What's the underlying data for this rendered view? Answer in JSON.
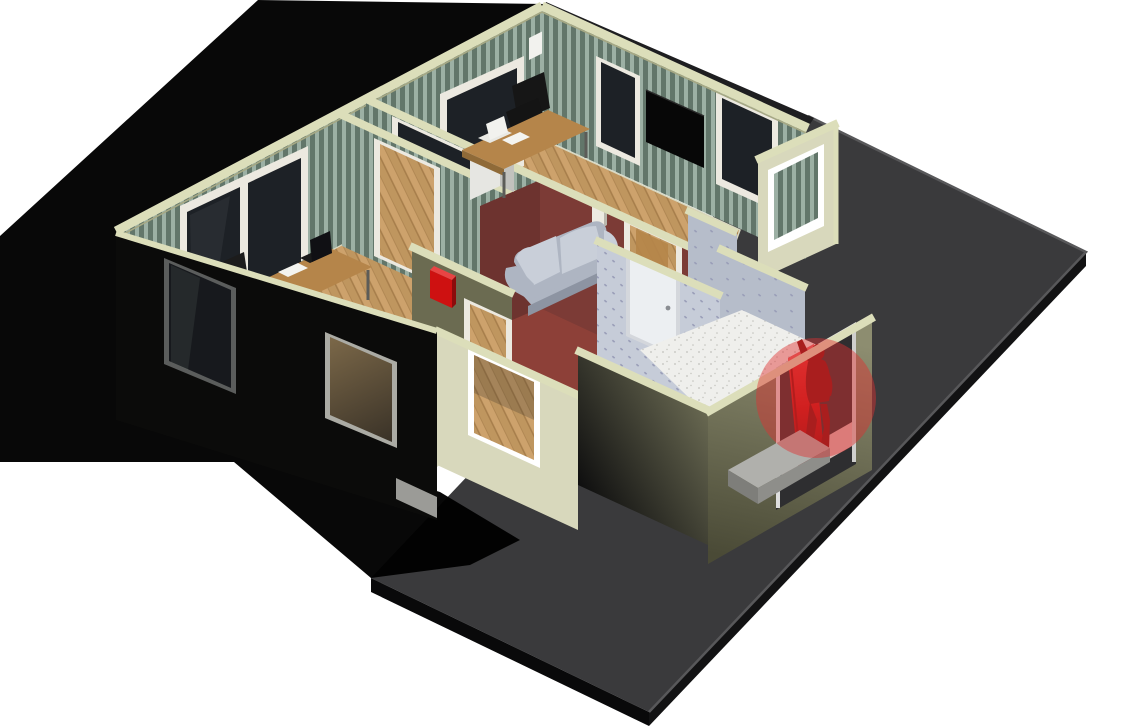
{
  "scene": {
    "title": "3D isometric cutaway floor-plan render",
    "view": "isometric",
    "alert": {
      "type": "person-detected-at-entrance",
      "marker": "translucent-red-circle",
      "marker_color": "#e03030",
      "marker_opacity": "0.45"
    }
  },
  "rooms": [
    {
      "id": "office-left",
      "floor": "wood-planks",
      "walls": "green-striped-wallpaper",
      "contents": [
        "l-desk",
        "laptop",
        "paper",
        "office-chair",
        "file-cabinet",
        "double-window"
      ]
    },
    {
      "id": "office-top",
      "floor": "wood-planks",
      "walls": "green-striped-wallpaper",
      "contents": [
        "l-desk",
        "laptop",
        "paper",
        "office-chair",
        "file-cabinet",
        "window",
        "wall-tv"
      ]
    },
    {
      "id": "living-room",
      "floor": "red-carpet",
      "walls": "maroon",
      "contents": [
        "gray-loveseat",
        "open-wood-door",
        "thermostat-box"
      ]
    },
    {
      "id": "hallway",
      "floor": "wood-planks",
      "walls": "olive",
      "contents": [
        "red-alarm-box",
        "doorway"
      ]
    },
    {
      "id": "entry-room",
      "floor": "white-speckled-tile",
      "walls": "blue-dotted-wallpaper",
      "contents": [
        "white-door",
        "red-entry-door",
        "person-figure",
        "concrete-step"
      ]
    }
  ],
  "colors": {
    "bg": "#ffffff",
    "slab_top": "#3a3a3c",
    "slab_side": "#121213",
    "slab_side2": "#09090a",
    "slab_edge": "#58585a",
    "shadow": "#000000",
    "roof_band": "#1e1e20",
    "cap": "#dcdeba",
    "cap_edge": "#a6a884",
    "stripe_a": "#62766a",
    "stripe_b": "#9cb0a4",
    "wood": "#cda26c",
    "wood_line": "#a87f4c",
    "wood_tint": "#bf965f",
    "maroon": "#7c3b36",
    "maroon_dark": "#6d332f",
    "carpet": "#8d4038",
    "olive": "#6b6b51",
    "black_wall": "#0b0b0a",
    "cream_wall": "#d8d8bc",
    "khaki_wall": "#8d8d70",
    "khaki_dark": "#55553f",
    "entry_paper": "#c6ccd8",
    "entry_paper_dark": "#b6bdca",
    "entry_dot": "#9a9eb8",
    "tile": "#efefec",
    "tile_dot": "#c2c2bc",
    "glass": "#1d2126",
    "glass_warm": "#6b5a42",
    "frame": "#ece9e0",
    "sofa": "#aeb5c2",
    "sofa_light": "#c9cfd9",
    "desk": "#b5854a",
    "desk_dark": "#8f6a38",
    "cabinet": "#e6e6e2",
    "cabinet_side": "#c6c6c2",
    "chair": "#141414",
    "alarm_red": "#ce1111",
    "door_red": "#c41212",
    "door_red_light": "#e46060",
    "figure_red": "#7d1010",
    "step": "#b0b0ac",
    "step_side": "#7e7e7a",
    "tv": "#070707",
    "detector": "#f2f2ee",
    "footer": "#9b9b97",
    "opening_dark": "#2e2e30"
  }
}
